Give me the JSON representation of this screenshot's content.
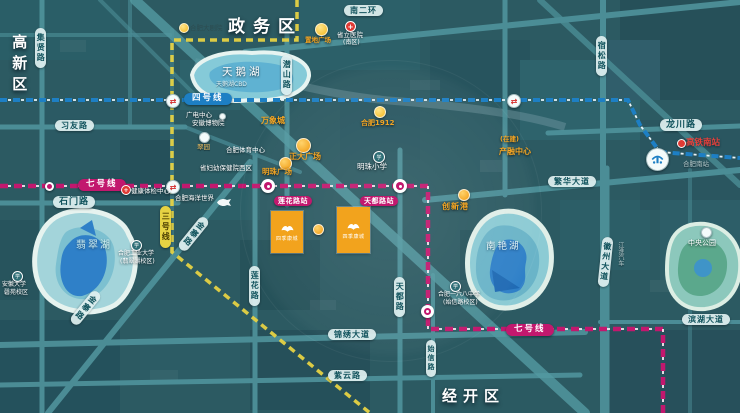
{
  "districts": {
    "gaoxin": "高新区",
    "zhengwu": "政务区",
    "jingkai": "经开区"
  },
  "metro": {
    "line4": "四号线",
    "line7": "七号线",
    "line7b": "七号线",
    "line3": "三号线"
  },
  "colors": {
    "line4": "#1d7fc4",
    "line7": "#c2186e",
    "line3": "#e6d243",
    "parcel": "#f2a31d",
    "road": "#4f929b"
  },
  "roads": {
    "jixian": "集贤路",
    "xiyou": "习友路",
    "shimen": "石门路",
    "qianshan": "潜山路",
    "nanerhuan": "南二环",
    "susong": "宿松路",
    "longchuan": "龙川路",
    "fanhua": "繁华大道",
    "huizhou": "徽州大道",
    "binhu": "滨湖大道",
    "lianhua": "莲花路",
    "tiandu": "天都路",
    "shixin": "始信路",
    "jinxiu": "锦绣大道",
    "ziyun": "紫云路",
    "jinzhai1": "金寨路",
    "jinzhai2": "金寨路"
  },
  "stations": {
    "lianhua": "莲花路站",
    "tiandu": "天都路站",
    "gaotie": "高铁南站",
    "hefeinan": "合肥南站"
  },
  "lakes": {
    "tianehu": "天鹅湖",
    "tianehu_sub": "天鹅湖CBD",
    "feicui": "翡翠湖",
    "nanyan": "南艳湖",
    "zhongyang": "中央公园"
  },
  "pois": {
    "dajuyuan": "合肥大剧院",
    "guangdian": "广电中心",
    "bowuyuan": "安徽博物院",
    "cuiyuan": "翠园",
    "tiyu": "合肥体育中心",
    "fuyou": "省妇幼保健院西区",
    "zhidi": "置地广场",
    "shengli1": "省立医院",
    "shengli2": "(南区)",
    "wanxiang": "万象城",
    "hf1912": "合肥1912",
    "zhengda": "正大广场",
    "mingzhugc": "明珠广场",
    "mingzhuxx": "明珠小学",
    "zaijian": "(在建)",
    "chanrong": "产融中心",
    "chuangxin": "创新港",
    "yiliuba1": "合肥一六八中学",
    "yiliuba2": "(始信路校区)",
    "gongda1": "合肥工业大学",
    "gongda2": "(翡翠湖校区)",
    "anda1": "安徽大学",
    "anda2": "磬苑校区",
    "tijian": "健康体检中心",
    "haiyang": "合肥海洋世界",
    "jianghuai": "江淮汽车"
  },
  "parcels": {
    "label": "四季康城"
  }
}
